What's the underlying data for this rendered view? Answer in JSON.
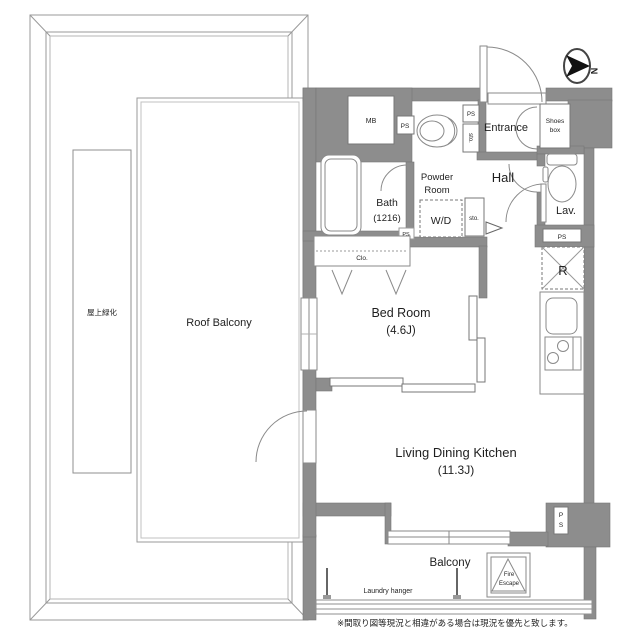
{
  "plan": {
    "rooms": {
      "roof_balcony": "Roof Balcony",
      "green_roof": "屋上緑化",
      "bedroom": {
        "name": "Bed Room",
        "size": "(4.6J)"
      },
      "ldk": {
        "name": "Living Dining Kitchen",
        "size": "(11.3J)"
      },
      "bath": {
        "name": "Bath",
        "size": "(1216)"
      },
      "powder_room": {
        "line1": "Powder",
        "line2": "Room"
      },
      "wd": "W/D",
      "closet": "Clo.",
      "entrance": "Entrance",
      "shoes_box": {
        "line1": "Shoes",
        "line2": "box"
      },
      "hall": "Hall",
      "lav": "Lav.",
      "balcony": "Balcony",
      "fire_escape": {
        "line1": "Fire",
        "line2": "Escape"
      },
      "laundry_hanger": "Laundry hanger",
      "fridge": "R",
      "meter_box": "MB"
    },
    "labels": {
      "ps": "PS",
      "sto": "sto.",
      "p": "P",
      "s": "S"
    },
    "compass": {
      "letter": "N"
    },
    "note": "※間取り図等現況と相違がある場合は現況を優先と致します。",
    "colors": {
      "wall": "#8d8d8d",
      "line": "#8f8f8f",
      "fixture": "#8a8a8a"
    }
  }
}
